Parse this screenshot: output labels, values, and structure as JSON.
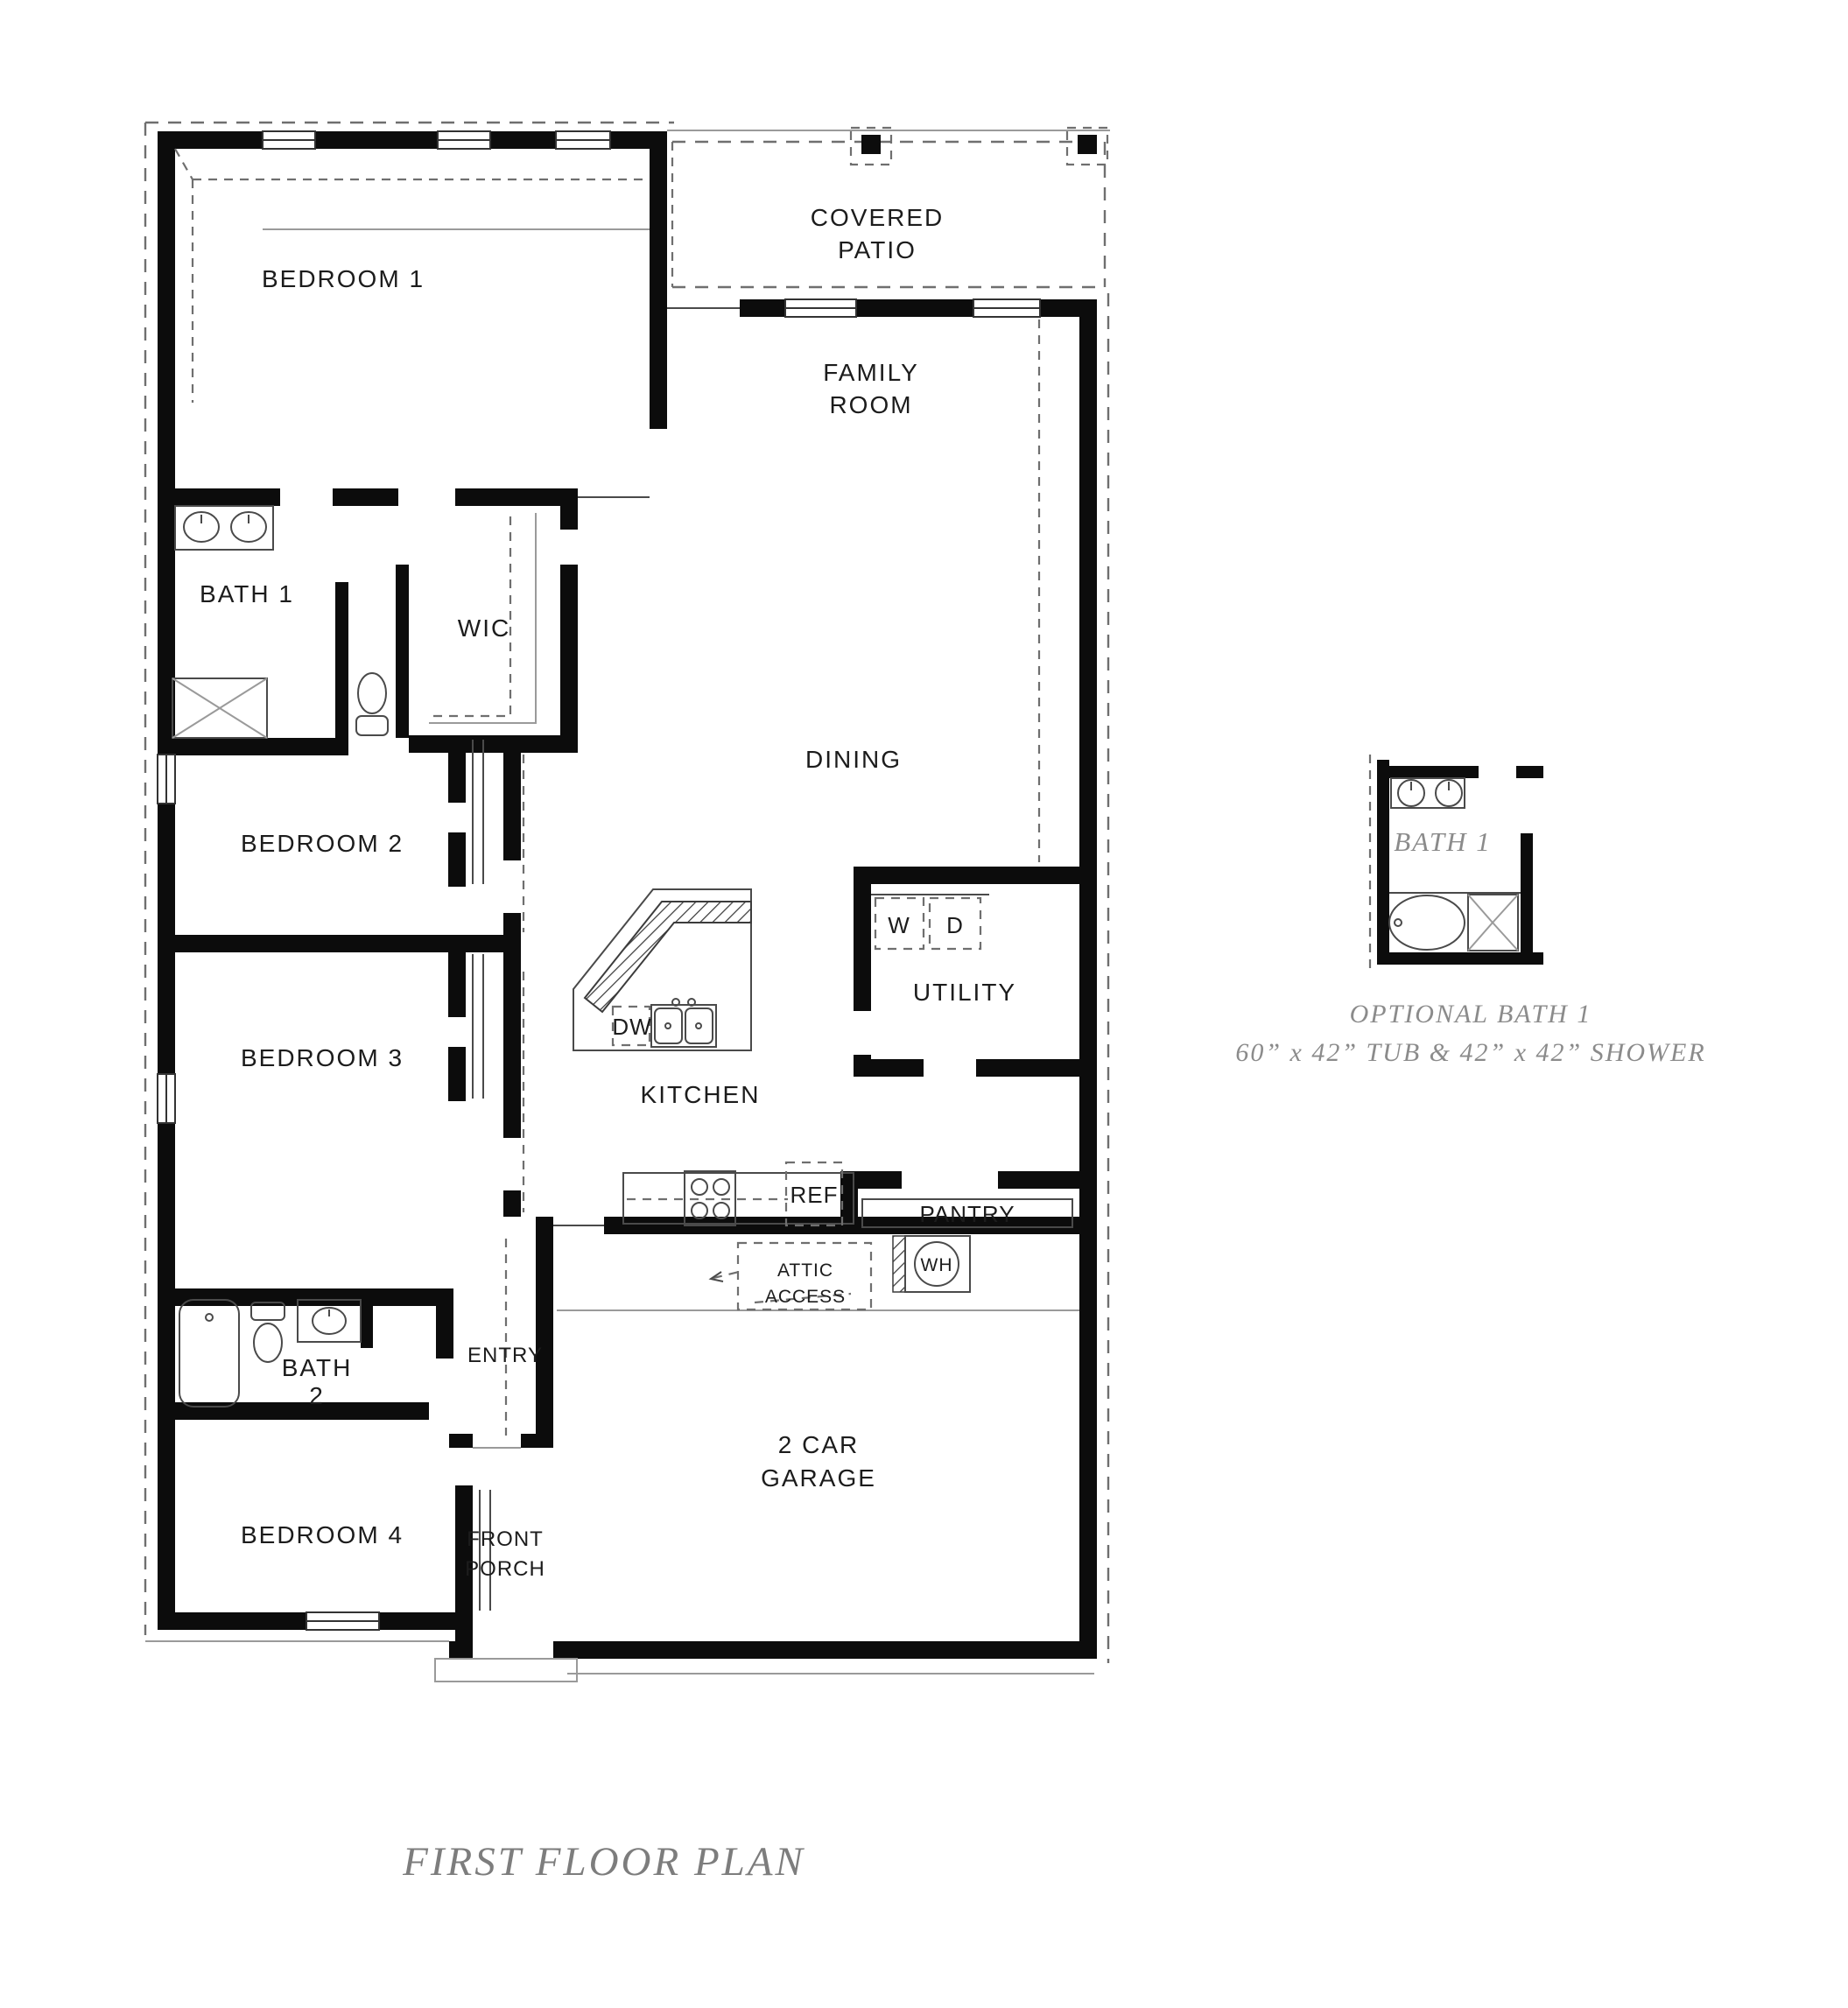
{
  "page": {
    "title": "FIRST FLOOR PLAN"
  },
  "rooms": {
    "covered_patio": [
      "COVERED",
      "PATIO"
    ],
    "bedroom1": "BEDROOM 1",
    "family_room": [
      "FAMILY",
      "ROOM"
    ],
    "bath1": "BATH 1",
    "wic": "WIC",
    "dining": "DINING",
    "bedroom2": "BEDROOM 2",
    "utility": "UTILITY",
    "kitchen": "KITCHEN",
    "bedroom3": "BEDROOM 3",
    "pantry": "PANTRY",
    "entry": "ENTRY",
    "bath2": [
      "BATH",
      "2"
    ],
    "bedroom4": "BEDROOM 4",
    "front_porch": [
      "FRONT",
      "PORCH"
    ],
    "garage": [
      "2 CAR",
      "GARAGE"
    ],
    "attic": [
      "ATTIC",
      "ACCESS"
    ]
  },
  "appliances": {
    "dw": "DW",
    "ref": "REF",
    "wh": "WH",
    "washer": "W",
    "dryer": "D"
  },
  "inset": {
    "room": "BATH 1",
    "caption": "OPTIONAL BATH 1",
    "dimensions": "60” x 42” TUB & 42” x 42” SHOWER"
  }
}
